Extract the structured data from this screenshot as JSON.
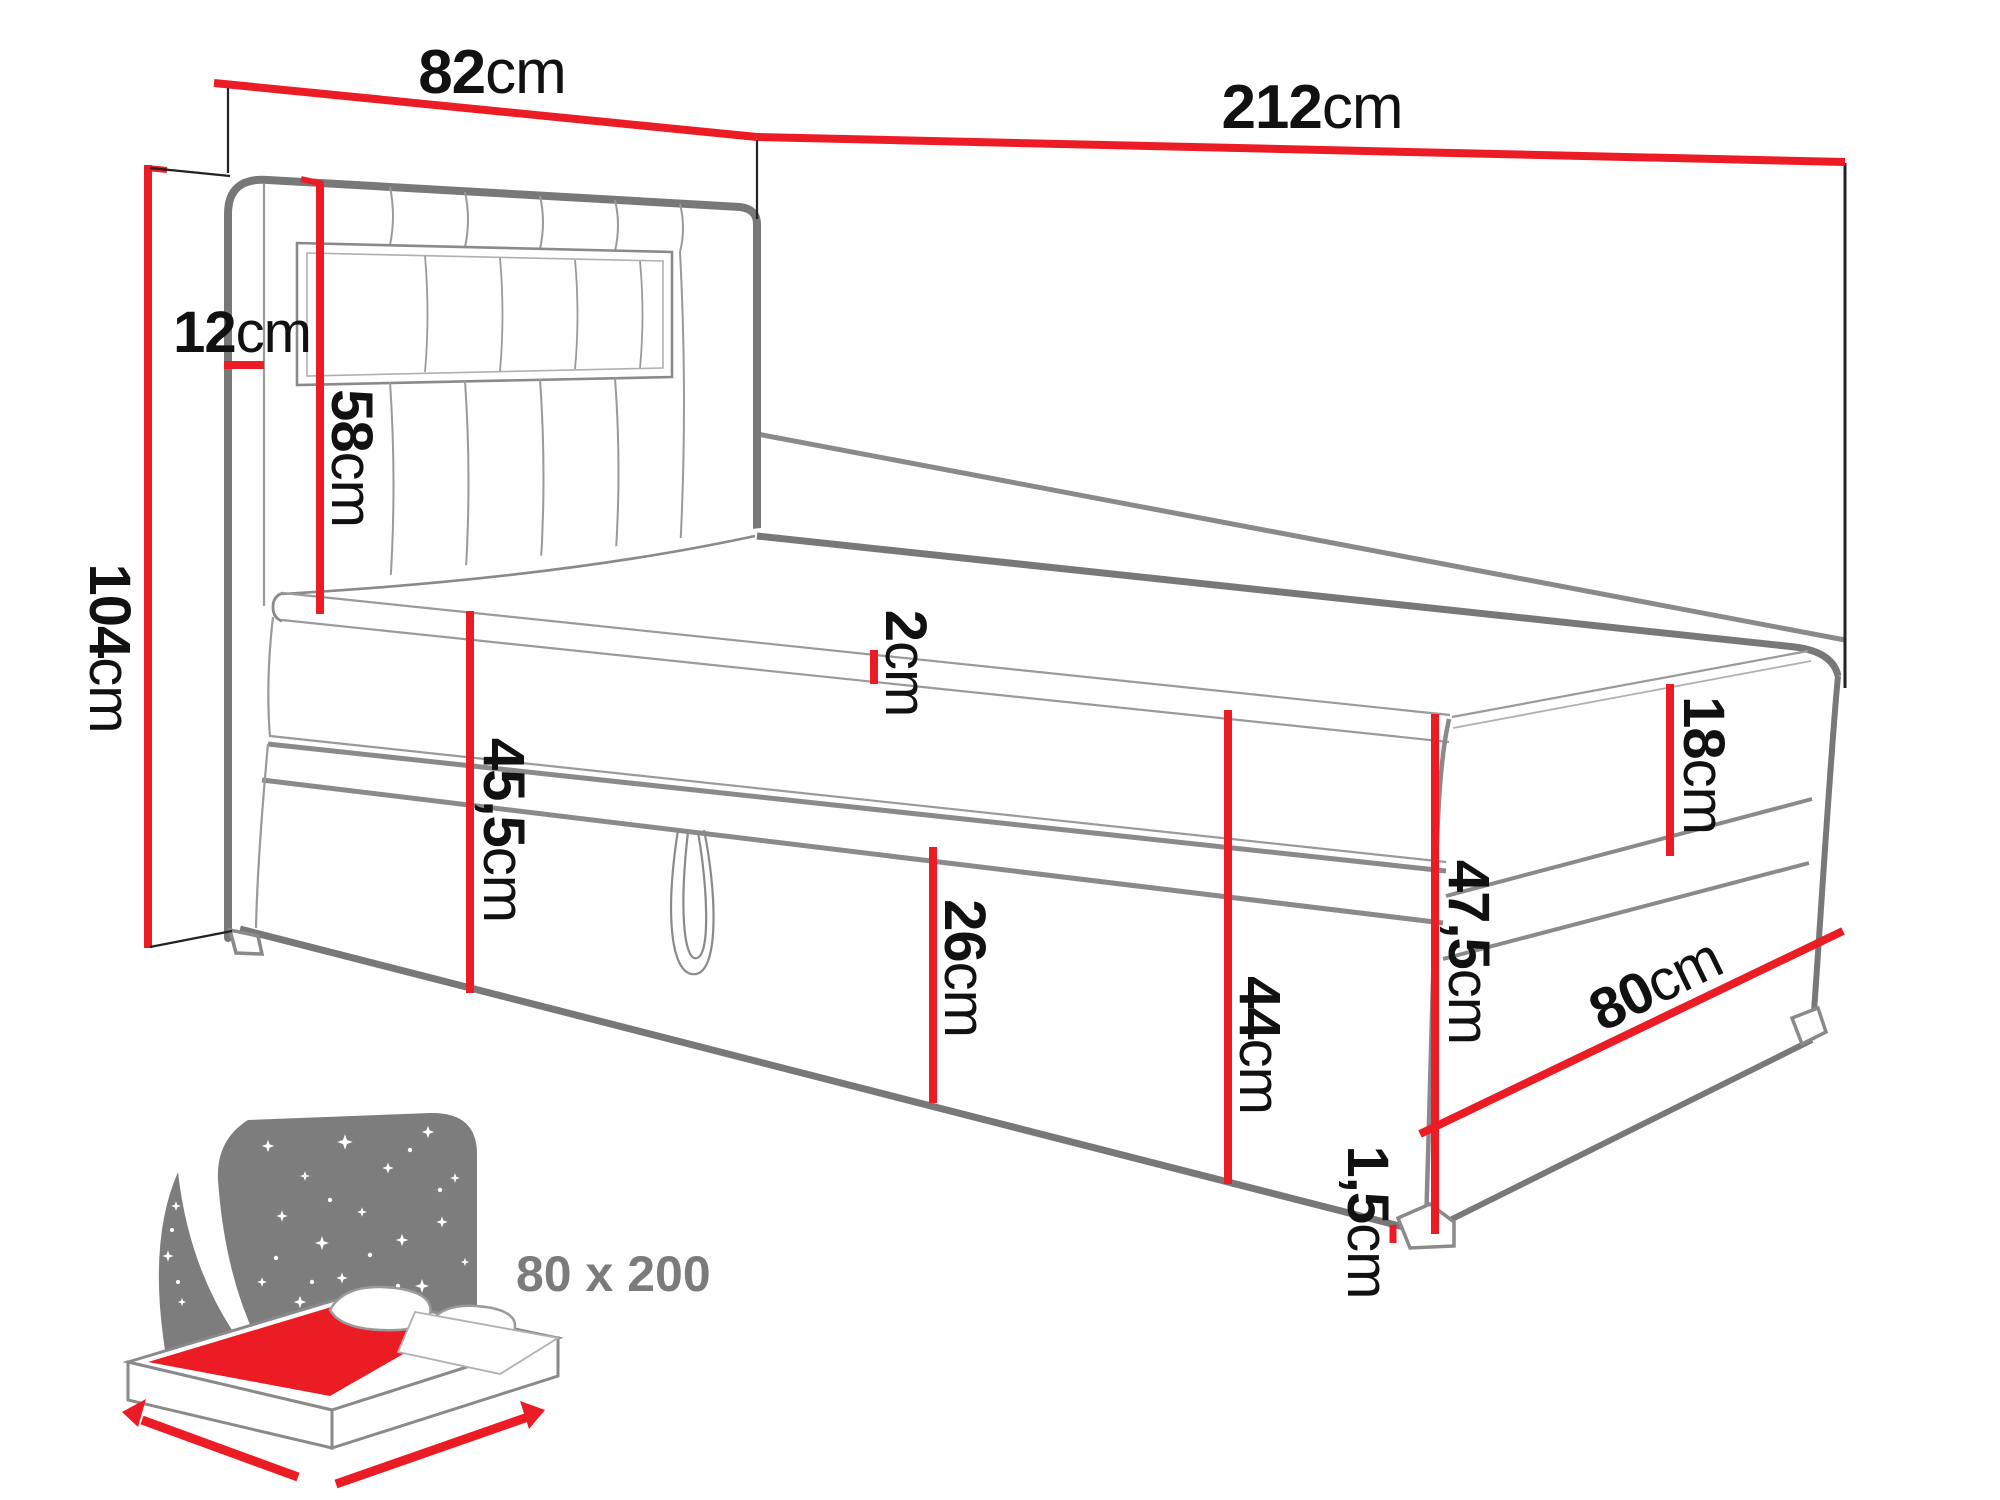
{
  "diagram_type": "bed dimension drawing",
  "unit": "cm",
  "dimension_labels": {
    "headboard_width": {
      "value": "82",
      "unit": "cm"
    },
    "total_length": {
      "value": "212",
      "unit": "cm"
    },
    "total_height": {
      "value": "104",
      "unit": "cm"
    },
    "headboard_depth": {
      "value": "12",
      "unit": "cm"
    },
    "headboard_above": {
      "value": "58",
      "unit": "cm"
    },
    "topper_thickness": {
      "value": "2",
      "unit": "cm"
    },
    "base_with_feet": {
      "value": "45,5",
      "unit": "cm"
    },
    "storage_flap": {
      "value": "26",
      "unit": "cm"
    },
    "base_front": {
      "value": "44",
      "unit": "cm"
    },
    "mattress_thickness": {
      "value": "18",
      "unit": "cm"
    },
    "side_height": {
      "value": "47,5",
      "unit": "cm"
    },
    "bed_width": {
      "value": "80",
      "unit": "cm"
    },
    "feet_height": {
      "value": "1,5",
      "unit": "cm"
    }
  },
  "icon": {
    "size_label": "80 x 200"
  },
  "colors": {
    "dimension_red": "#ec1c24",
    "outline_gray": "#787878",
    "label_black": "#111111",
    "icon_gray": "#7d7d7d"
  }
}
